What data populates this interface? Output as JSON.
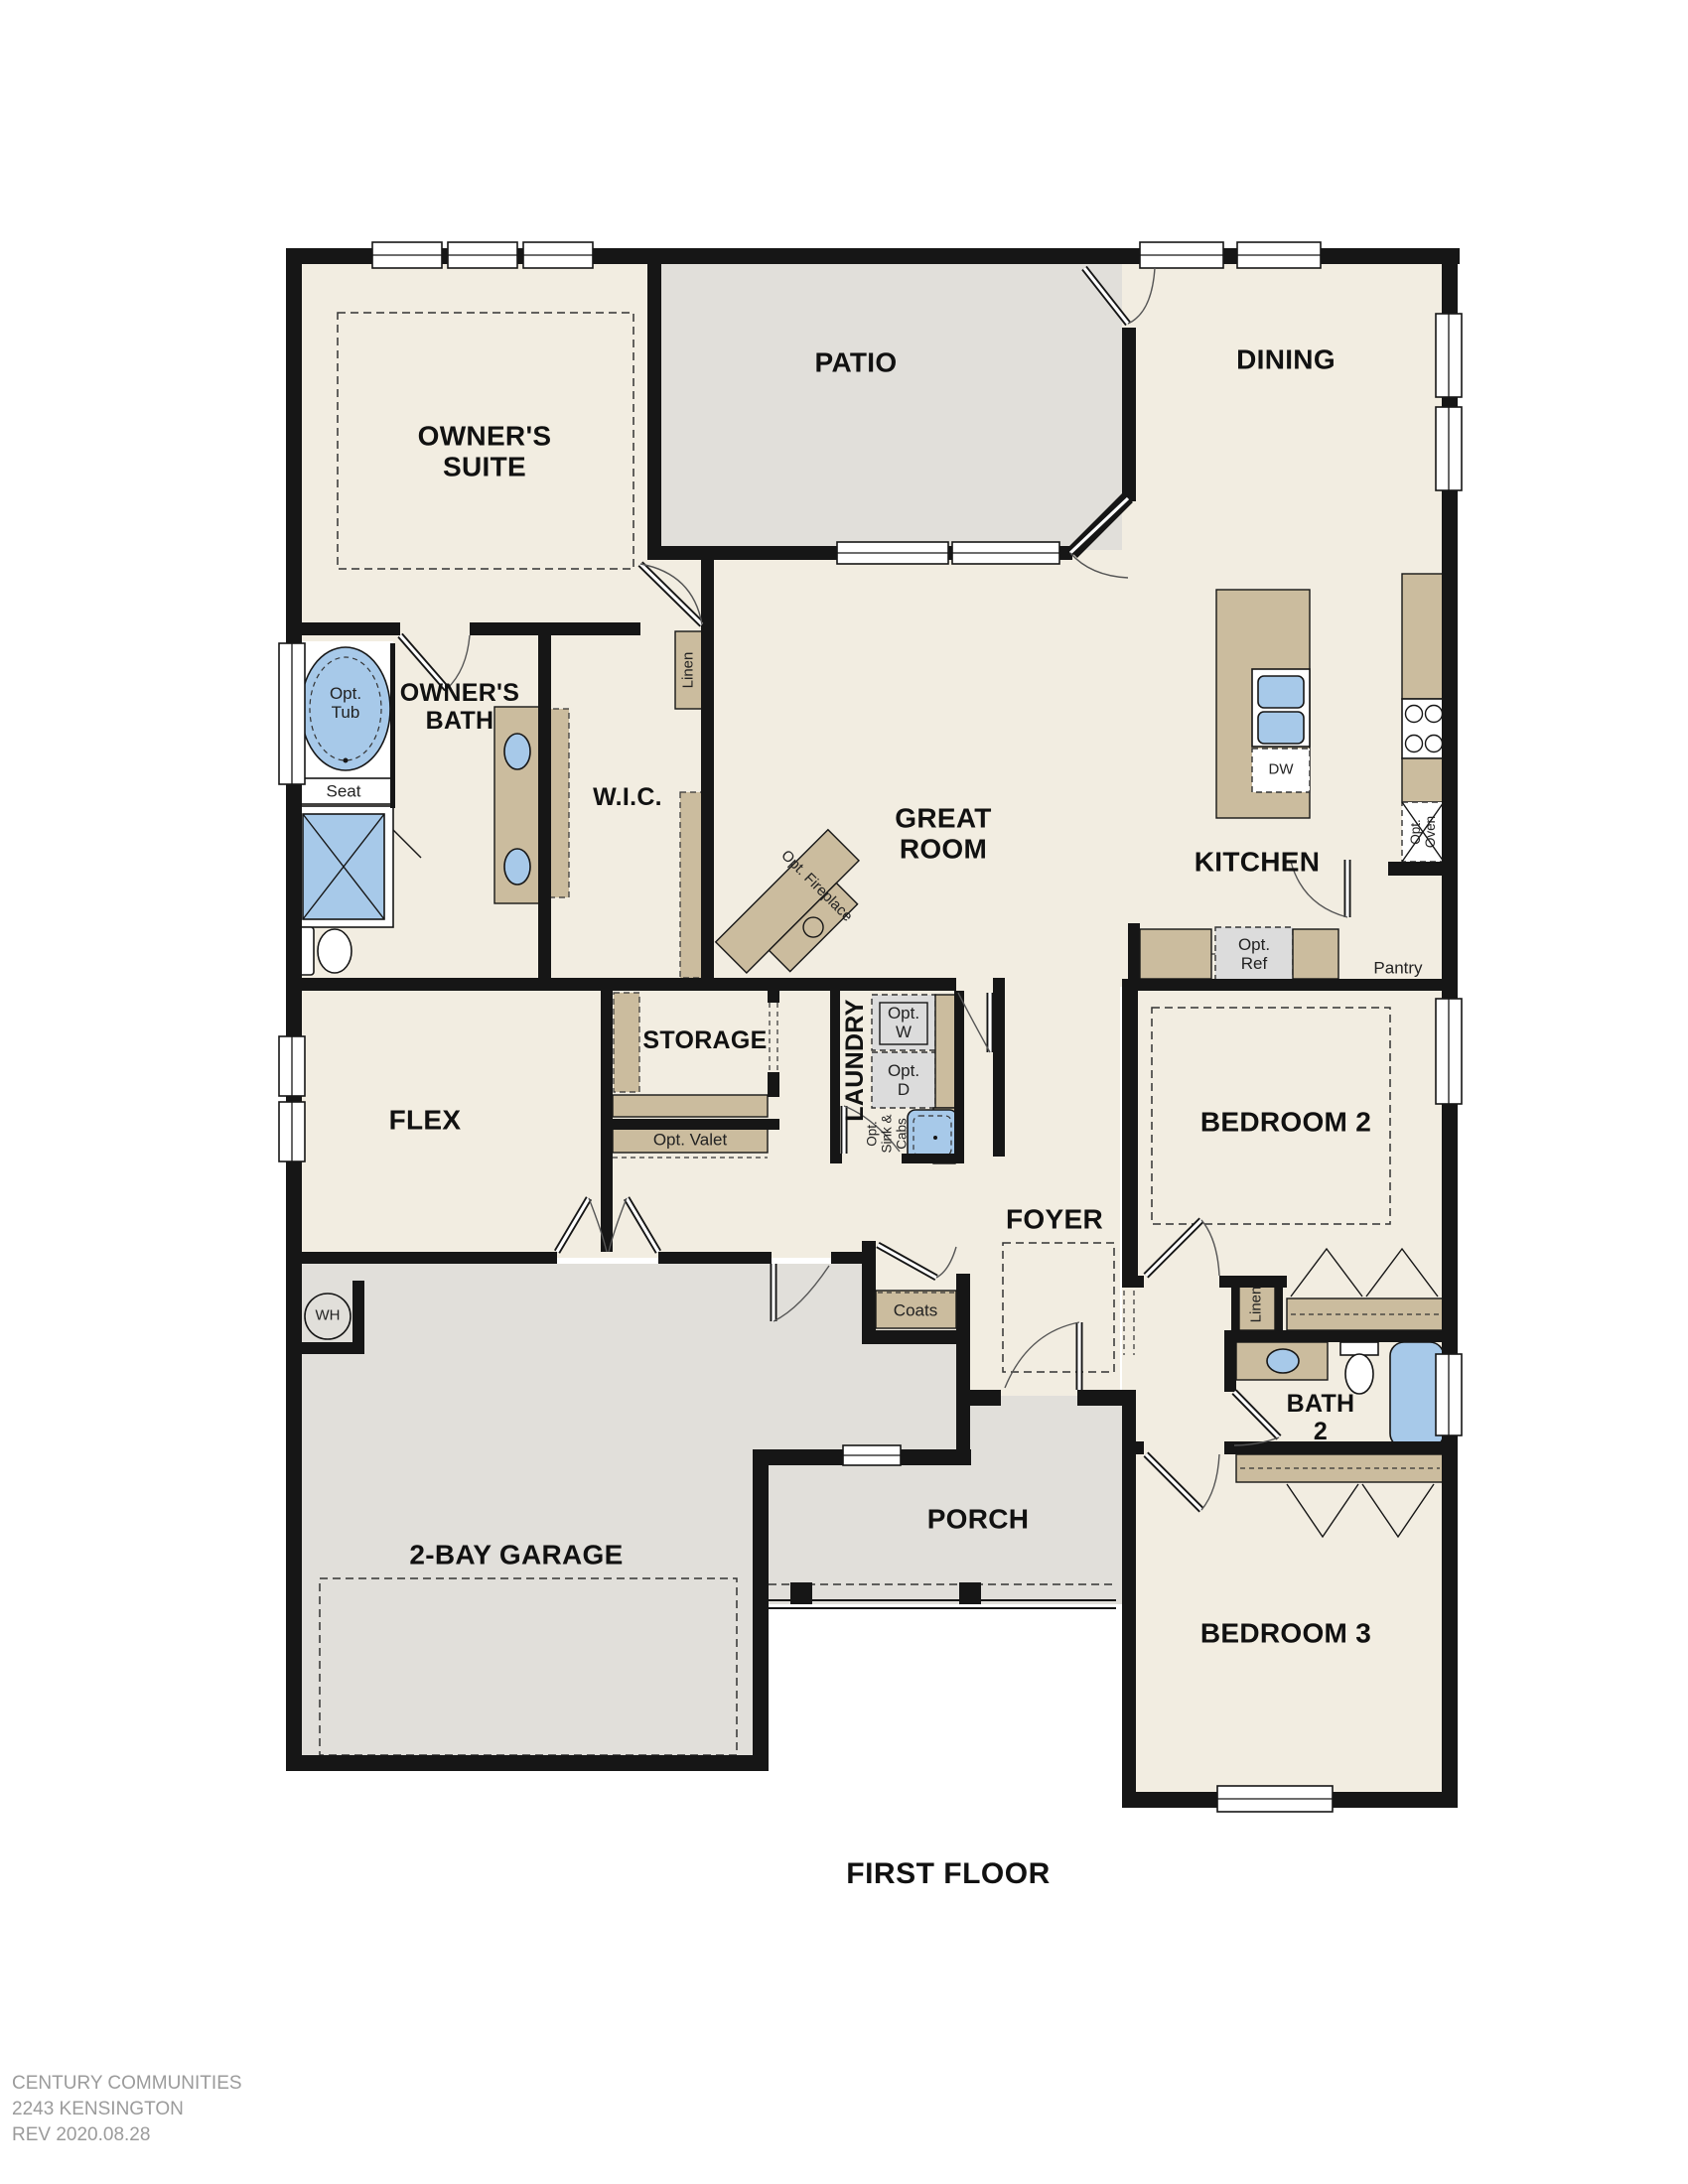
{
  "title": "FIRST FLOOR",
  "footer": {
    "company": "CENTURY COMMUNITIES",
    "plan_number": "2243 KENSINGTON",
    "revision": "REV 2020.08.28"
  },
  "rooms": {
    "owners_suite": "OWNER'S\nSUITE",
    "patio": "PATIO",
    "dining": "DINING",
    "owners_bath": "OWNER'S\nBATH",
    "wic": "W.I.C.",
    "great_room": "GREAT\nROOM",
    "kitchen": "KITCHEN",
    "storage": "STORAGE",
    "laundry": "LAUNDRY",
    "flex": "FLEX",
    "foyer": "FOYER",
    "bedroom2": "BEDROOM 2",
    "bath2": "BATH\n2",
    "bedroom3": "BEDROOM 3",
    "garage": "2-BAY GARAGE",
    "porch": "PORCH"
  },
  "features": {
    "opt_tub": "Opt.\nTub",
    "seat": "Seat",
    "linen_wic": "Linen",
    "linen_hall": "Linen",
    "dw": "DW",
    "opt_oven": "Opt.\nOven",
    "opt_ref": "Opt.\nRef",
    "pantry": "Pantry",
    "opt_w": "Opt.\nW",
    "opt_d": "Opt.\nD",
    "opt_sink_cabs": "Opt.\nSink &\nCabs",
    "opt_valet": "Opt. Valet",
    "opt_fireplace": "Opt. Fireplace",
    "coats": "Coats",
    "water_heater": "WH"
  },
  "colors": {
    "beige": "#F2EDE1",
    "gray": "#E1DFDA",
    "tan": "#CBBC9E",
    "blue": "#A7C9E9",
    "wall": "#161616",
    "appliance": "#DCDCDC",
    "footerText": "#9B9B9B"
  }
}
